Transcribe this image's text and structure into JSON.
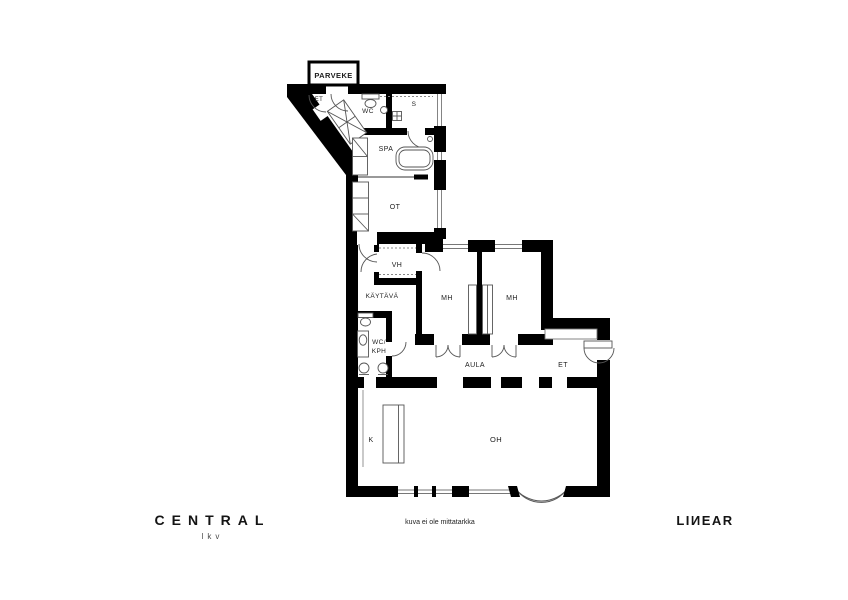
{
  "plan": {
    "balcony_label": "PARVEKE",
    "rooms": {
      "entry_small": "ET",
      "wc": "WC",
      "sauna": "S",
      "spa": "SPA",
      "ot": "OT",
      "vh": "VH",
      "corridor": "KÄYTÄVÄ",
      "bedroom1": "MH",
      "bedroom2": "MH",
      "wc_kph_line1": "WC/",
      "wc_kph_line2": "KPH",
      "aula": "AULA",
      "entry": "ET",
      "kitchen": "K",
      "living": "OH"
    }
  },
  "footer": {
    "brand_left_name": "CENTRAL",
    "brand_left_sub": "lkv",
    "disclaimer": "kuva ei ole mittatarkka",
    "brand_right": "LIИEAR"
  },
  "colors": {
    "wall": "#000000",
    "background": "#ffffff",
    "fixture_line": "#4a4a4a"
  }
}
